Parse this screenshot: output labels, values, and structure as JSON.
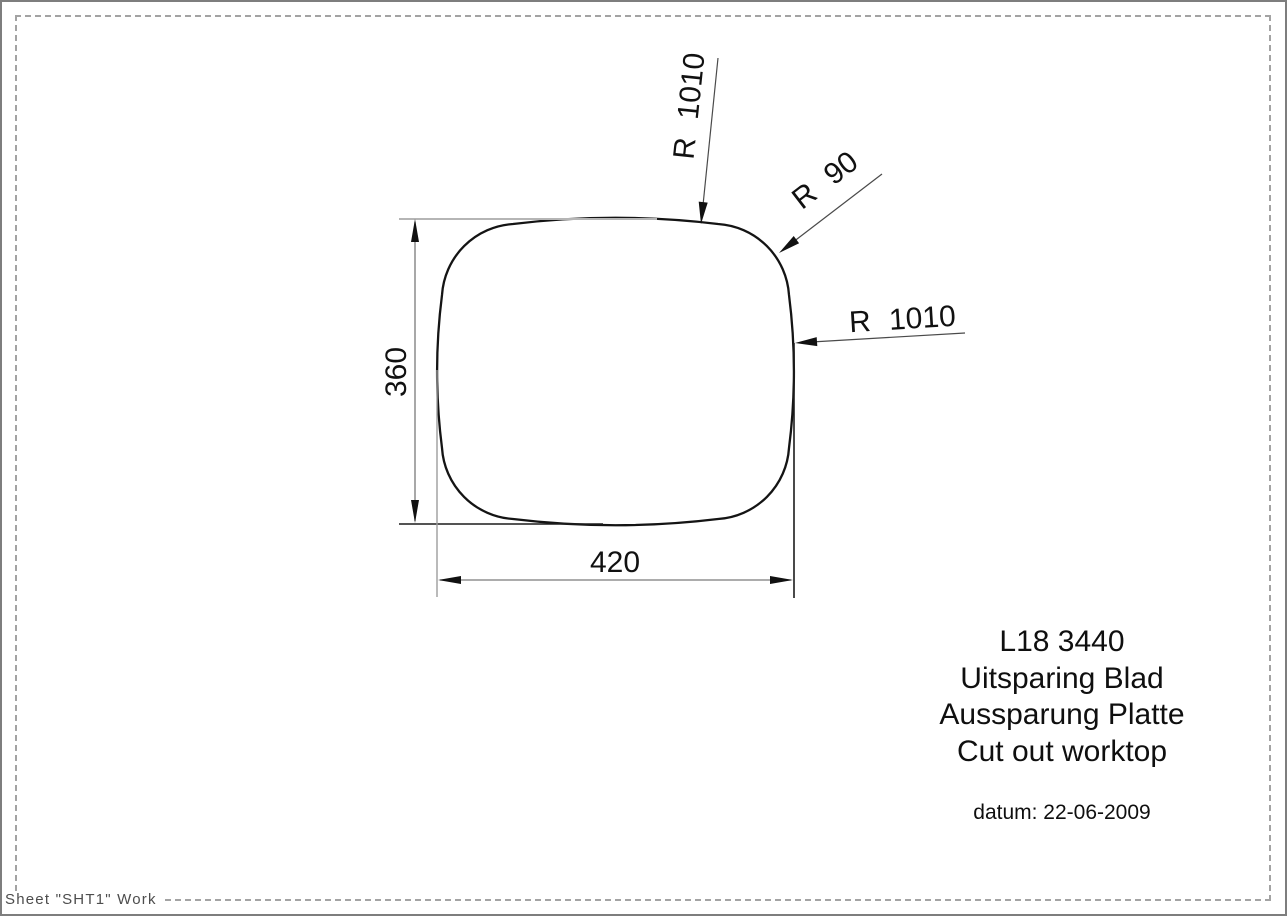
{
  "page": {
    "sheet_label": "Sheet \"SHT1\" Work"
  },
  "drawing": {
    "dimensions": {
      "width": "420",
      "height": "360"
    },
    "radius_annotations": [
      {
        "label": "R 1010",
        "target": "top-edge"
      },
      {
        "label": "R 90",
        "target": "top-right-corner"
      },
      {
        "label": "R 1010",
        "target": "right-edge"
      }
    ],
    "title_block": {
      "lines": [
        "L18 3440",
        "Uitsparing Blad",
        "Aussparung Platte",
        "Cut out worktop"
      ],
      "date": "datum: 22-06-2009"
    },
    "colors": {
      "outline": "#141414",
      "dimension_line": "#7a7a7a",
      "extension_light": "#b5b5b5",
      "extension_dark": "#1c1c1c",
      "frame_dashed": "#a3a3a3",
      "frame_solid": "#7e7e7e"
    }
  }
}
